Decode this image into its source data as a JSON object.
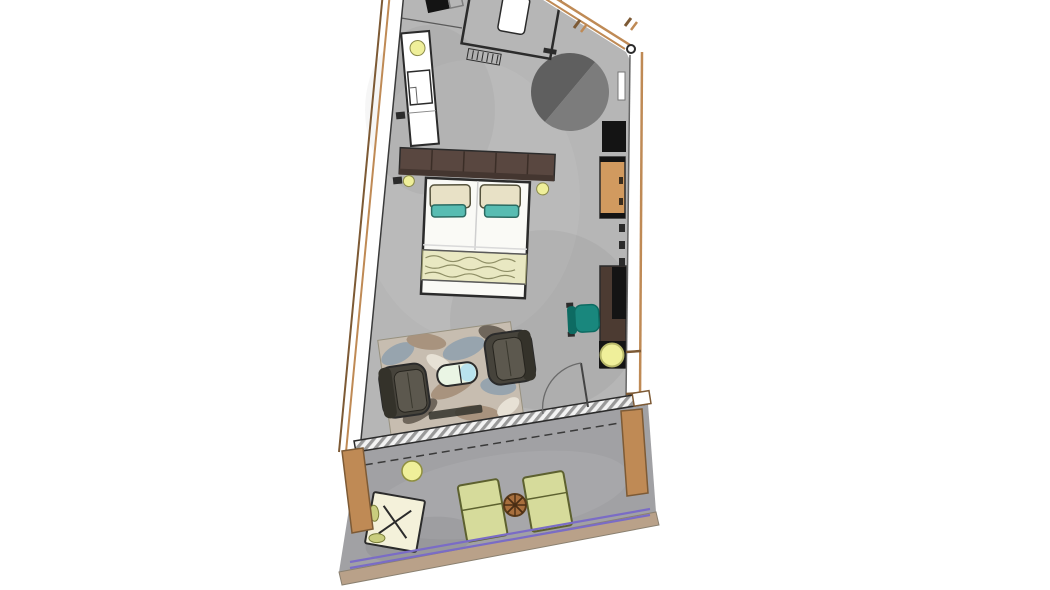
{
  "labels": {
    "plan_aria": "floor plan"
  },
  "colors": {
    "page_bg": "#ffffff",
    "outline_dark": "#2b2b2b",
    "outline_soft": "#5a5a5a",
    "room_floor": "#b6b6b6",
    "balcony_floor": "#a1a1a4",
    "wall_white": "#ffffff",
    "wall_wood": "#bf8a55",
    "wall_wood_dark": "#7d5a35",
    "fascia_tan": "#b9a189",
    "railing_purple": "#7a6cc6",
    "rug_round_dark": "#5f5f5f",
    "rug_round_light": "#7c7c7c",
    "headboard": "#594740",
    "headboard_dark": "#443630",
    "bed_white": "#fafaf6",
    "pillow_cream": "#e8e1c6",
    "pillow_teal": "#58bcb2",
    "throw_cream": "#e9e8c2",
    "throw_line": "#8f8f66",
    "lamp_yellow": "#efef9a",
    "wardrobe_tan": "#d19a5f",
    "console_black": "#141414",
    "desk_brown": "#4c3b32",
    "chair_teal": "#19877d",
    "chair_teal_dark": "#0d6b62",
    "armchair_body": "#46433b",
    "armchair_back": "#34322a",
    "armchair_seat": "#5c584e",
    "area_rug_base": "#c7bdb0",
    "camo_blue": "#97a4ae",
    "camo_tan": "#a8937e",
    "camo_dark": "#6f665b",
    "camo_light": "#e7e1d5",
    "rug_bar": "#32322c",
    "table_pale": "#eaf5e4",
    "table_blue": "#b9e3ee",
    "lounger_green": "#d6db9b",
    "lounger_edge": "#5d612f",
    "balcony_table_brown": "#a86f3d",
    "balcony_table_dark": "#4a2e14",
    "xtable_cream": "#f4f1da",
    "leaf_olive": "#c9cd7e",
    "hatch_gray": "#999999",
    "hatch_bg": "#f3f3f3"
  },
  "plan": {
    "kind": "architectural-floor-plan",
    "areas": [
      {
        "id": "guest-room",
        "label": "guest room"
      },
      {
        "id": "bath-zone",
        "label": "shower and vanity zone"
      },
      {
        "id": "balcony",
        "label": "balcony terrace"
      }
    ],
    "furniture": [
      {
        "id": "entry-door",
        "label": "entry door"
      },
      {
        "id": "shower-enclosure",
        "label": "glass shower enclosure"
      },
      {
        "id": "shower-tray",
        "label": "shower fixture"
      },
      {
        "id": "vanity-counter",
        "label": "vanity counter with basin"
      },
      {
        "id": "round-rug",
        "label": "round dark rug"
      },
      {
        "id": "console",
        "label": "black console"
      },
      {
        "id": "wardrobe",
        "label": "wooden wardrobe"
      },
      {
        "id": "double-bed",
        "label": "double bed"
      },
      {
        "id": "headboard",
        "label": "upholstered headboard"
      },
      {
        "id": "bedside-lamps",
        "label": "bedside lamps"
      },
      {
        "id": "desk",
        "label": "wall desk"
      },
      {
        "id": "desk-chair",
        "label": "teal desk chair"
      },
      {
        "id": "floor-lamp",
        "label": "round lamp on black base"
      },
      {
        "id": "area-rug",
        "label": "patterned area rug"
      },
      {
        "id": "armchairs",
        "label": "two dark armchairs"
      },
      {
        "id": "coffee-table",
        "label": "two-tone coffee table"
      },
      {
        "id": "balcony-door",
        "label": "swing door to balcony"
      },
      {
        "id": "window-track",
        "label": "glazed sliding wall track"
      },
      {
        "id": "sun-loungers",
        "label": "two sun loungers"
      },
      {
        "id": "balcony-side-table",
        "label": "round wooden side table"
      },
      {
        "id": "planter",
        "label": "round planter"
      },
      {
        "id": "folding-table",
        "label": "folding table with cushion"
      },
      {
        "id": "railing",
        "label": "balcony railing"
      }
    ]
  }
}
